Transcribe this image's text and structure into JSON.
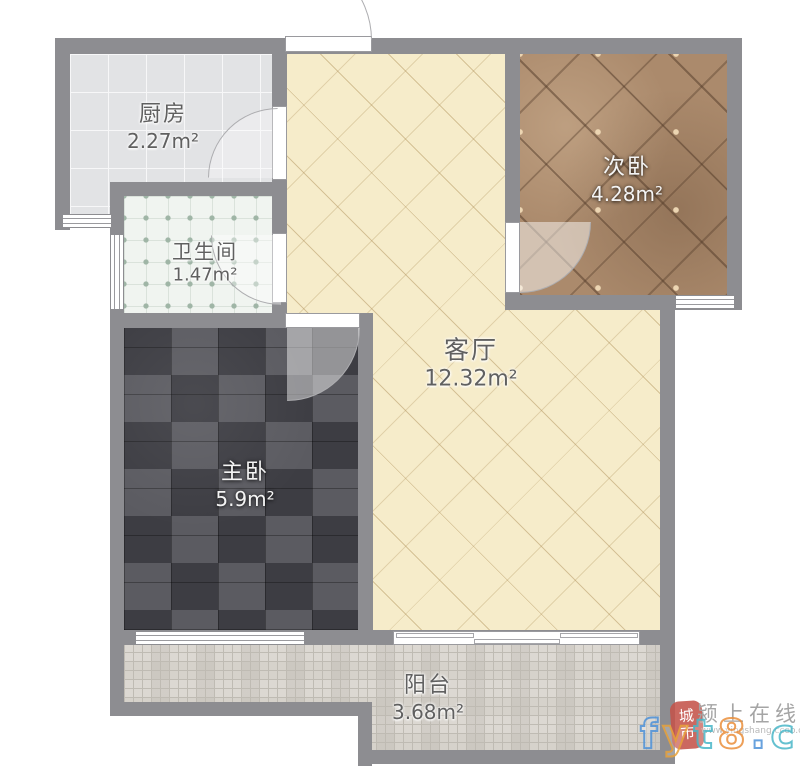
{
  "rooms": [
    {
      "name": "厨房",
      "area": "2.27m²"
    },
    {
      "name": "卫生间",
      "area": "1.47m²"
    },
    {
      "name": "主卧",
      "area": "5.9m²"
    },
    {
      "name": "客厅",
      "area": "12.32m²"
    },
    {
      "name": "次卧",
      "area": "4.28m²"
    },
    {
      "name": "阳台",
      "area": "3.68m²"
    }
  ],
  "watermark": {
    "seal_text": "城市",
    "site_name": "颍上在线",
    "site_url": "www.yingshang.ccoo.cn",
    "big_text": "fyt8.cn",
    "letter_colors": [
      "#4e92d9",
      "#e9a33b",
      "#49b7c8",
      "#ea8f3b",
      "#4e92d9",
      "#49b7c8",
      "#e9a33b"
    ]
  },
  "colors": {
    "wall": "#8d8d91",
    "kitchen_floor": "#e2e3e5",
    "bathroom_floor": "#f0f4f0",
    "living_floor": "#f6ecca",
    "master_floor": "#4c4c52",
    "second_floor": "#ab8a6c",
    "balcony_floor": "#d6d2cb",
    "seal_red": "#c4544b"
  }
}
